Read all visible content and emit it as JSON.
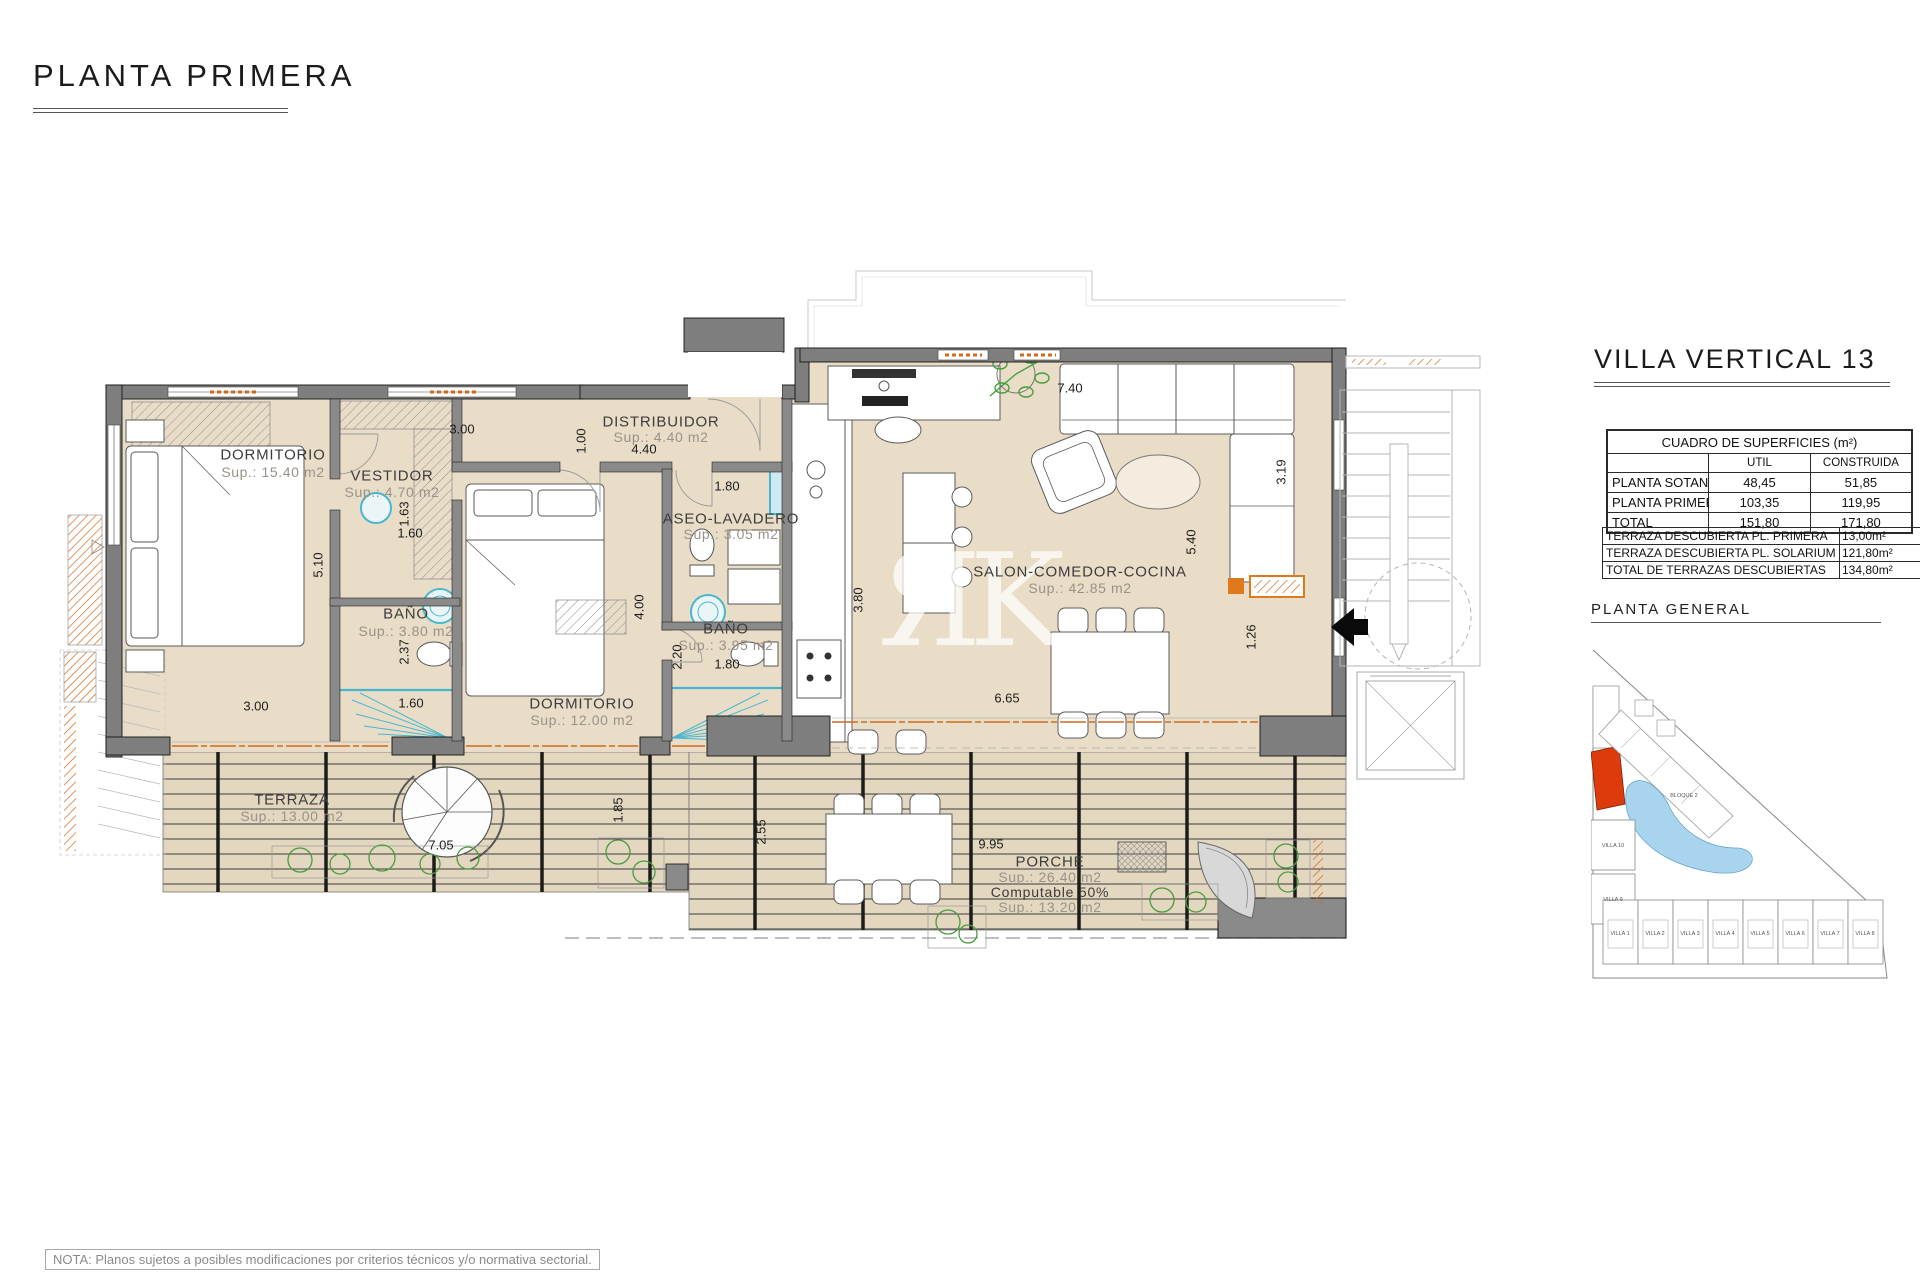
{
  "page": {
    "title": "PLANTA PRIMERA",
    "note": "NOTA: Planos sujetos a posibles modificaciones por criterios técnicos y/o normativa sectorial."
  },
  "sidebar": {
    "villa_title": "VILLA VERTICAL 13",
    "surfaces_table": {
      "title": "CUADRO DE SUPERFICIES (m²)",
      "col_util": "UTIL",
      "col_construida": "CONSTRUIDA",
      "rows": [
        {
          "label": "PLANTA SOTANO",
          "util": "48,45",
          "construida": "51,85"
        },
        {
          "label": "PLANTA PRIMERA",
          "util": "103,35",
          "construida": "119,95"
        },
        {
          "label": "TOTAL",
          "util": "151,80",
          "construida": "171,80"
        }
      ]
    },
    "terraces_table": {
      "rows": [
        {
          "label": "TERRAZA DESCUBIERTA PL. PRIMERA",
          "value": "13,00m²"
        },
        {
          "label": "TERRAZA DESCUBIERTA PL. SOLARIUM",
          "value": "121,80m²"
        },
        {
          "label": "TOTAL DE TERRAZAS DESCUBIERTAS",
          "value": "134,80m²"
        }
      ]
    },
    "site_plan": {
      "title": "PLANTA GENERAL",
      "bloque_label": "BLOQUE 2",
      "villa10": "VILLA 10",
      "villa9": "VILLA 9",
      "villas_row": [
        "VILLA 1",
        "VILLA 2",
        "VILLA 3",
        "VILLA 4",
        "VILLA 5",
        "VILLA 6",
        "VILLA 7",
        "VILLA 8"
      ],
      "highlight_color": "#dd3b0c",
      "pool_color": "#a9d4ee"
    }
  },
  "plan": {
    "watermark": "ЯK",
    "rooms": [
      {
        "name": "DORMITORIO",
        "sup": "Sup.: 15.40 m2"
      },
      {
        "name": "VESTIDOR",
        "sup": "Sup.: 4.70 m2"
      },
      {
        "name": "DISTRIBUIDOR",
        "sup": "Sup.: 4.40 m2"
      },
      {
        "name": "ASEO-LAVADERO",
        "sup": "Sup.: 3.05 m2"
      },
      {
        "name": "BAÑO",
        "sup": "Sup.: 3.80 m2"
      },
      {
        "name": "BAÑO",
        "sup": "Sup.: 3.95 m2"
      },
      {
        "name": "DORMITORIO",
        "sup": "Sup.: 12.00 m2"
      },
      {
        "name": "SALON-COMEDOR-COCINA",
        "sup": "Sup.: 42.85 m2"
      },
      {
        "name": "TERRAZA",
        "sup": "Sup.: 13.00 m2"
      }
    ],
    "porche": {
      "name": "PORCHE",
      "sup": "Sup.: 26.40 m2",
      "computable": "Computable 50%",
      "sup2": "Sup.: 13.20 m2"
    },
    "dimensions": [
      {
        "text": "4.40"
      },
      {
        "text": "1.00"
      },
      {
        "text": "3.00"
      },
      {
        "text": "1.80"
      },
      {
        "text": "1.63"
      },
      {
        "text": "1.60"
      },
      {
        "text": "5.10"
      },
      {
        "text": "2.37"
      },
      {
        "text": "1.60"
      },
      {
        "text": "3.00"
      },
      {
        "text": "4.00"
      },
      {
        "text": "2.20"
      },
      {
        "text": "1.80"
      },
      {
        "text": "3.80"
      },
      {
        "text": "7.40"
      },
      {
        "text": "5.40"
      },
      {
        "text": "3.19"
      },
      {
        "text": "1.26"
      },
      {
        "text": "6.65"
      },
      {
        "text": "1.85"
      },
      {
        "text": "2.55"
      },
      {
        "text": "7.05"
      },
      {
        "text": "9.95"
      }
    ]
  }
}
